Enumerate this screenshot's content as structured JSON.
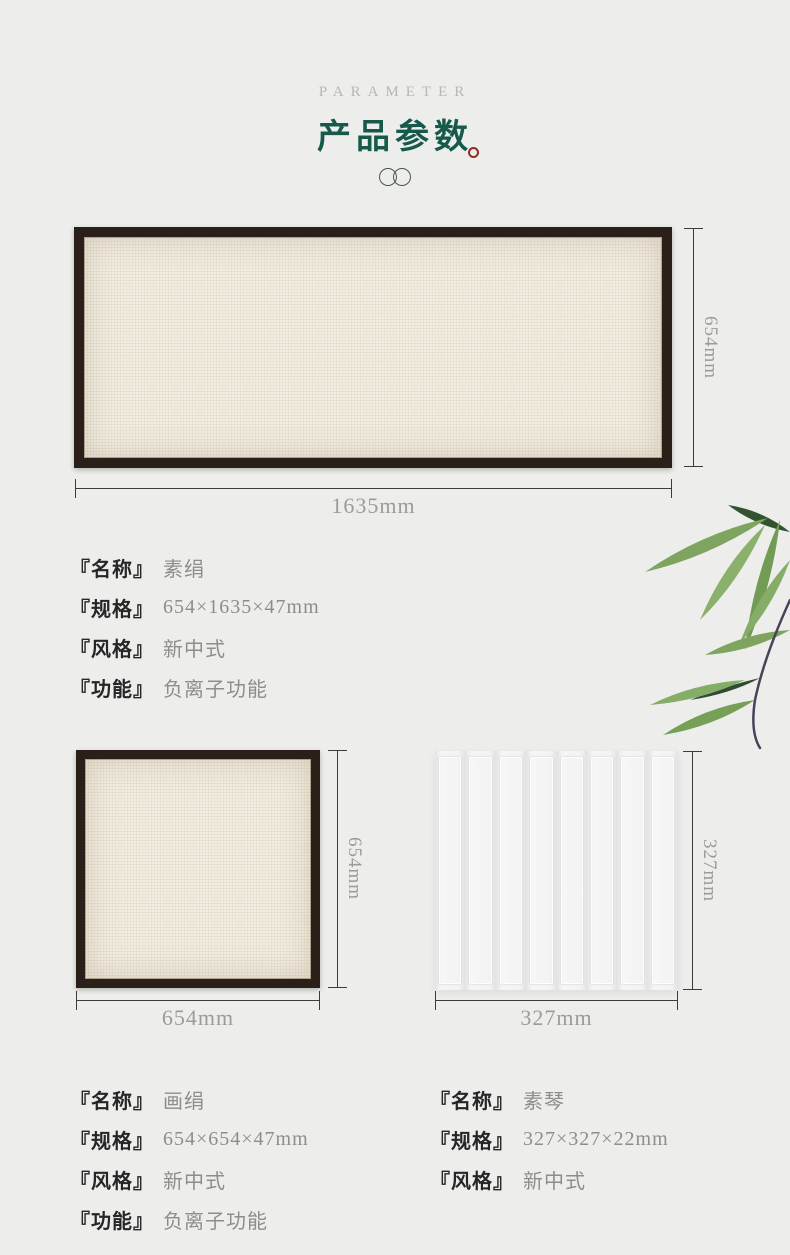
{
  "header": {
    "eyebrow": "PARAMETER",
    "title": "产品参数"
  },
  "colors": {
    "background": "#edeeec",
    "title_green": "#17594b",
    "seal_red": "#8f2d27",
    "frame_brown": "#2b2019",
    "canvas_cream": "#f2ede1",
    "dimension_text": "#9b9b9b",
    "spec_value_gray": "#8d8d8d",
    "bamboo_green": "#7ea45f"
  },
  "products": [
    {
      "dims": {
        "width": "1635mm",
        "height": "654mm"
      },
      "specs": [
        {
          "label": "『名称』",
          "value": "素绢"
        },
        {
          "label": "『规格』",
          "value": "654×1635×47mm"
        },
        {
          "label": "『风格』",
          "value": "新中式"
        },
        {
          "label": "『功能』",
          "value": "负离子功能"
        }
      ]
    },
    {
      "dims": {
        "width": "654mm",
        "height": "654mm"
      },
      "specs": [
        {
          "label": "『名称』",
          "value": "画绢"
        },
        {
          "label": "『规格』",
          "value": "654×654×47mm"
        },
        {
          "label": "『风格』",
          "value": "新中式"
        },
        {
          "label": "『功能』",
          "value": "负离子功能"
        }
      ]
    },
    {
      "dims": {
        "width": "327mm",
        "height": "327mm"
      },
      "ribs": 8,
      "specs": [
        {
          "label": "『名称』",
          "value": "素琴"
        },
        {
          "label": "『规格』",
          "value": "327×327×22mm"
        },
        {
          "label": "『风格』",
          "value": "新中式"
        }
      ]
    }
  ]
}
